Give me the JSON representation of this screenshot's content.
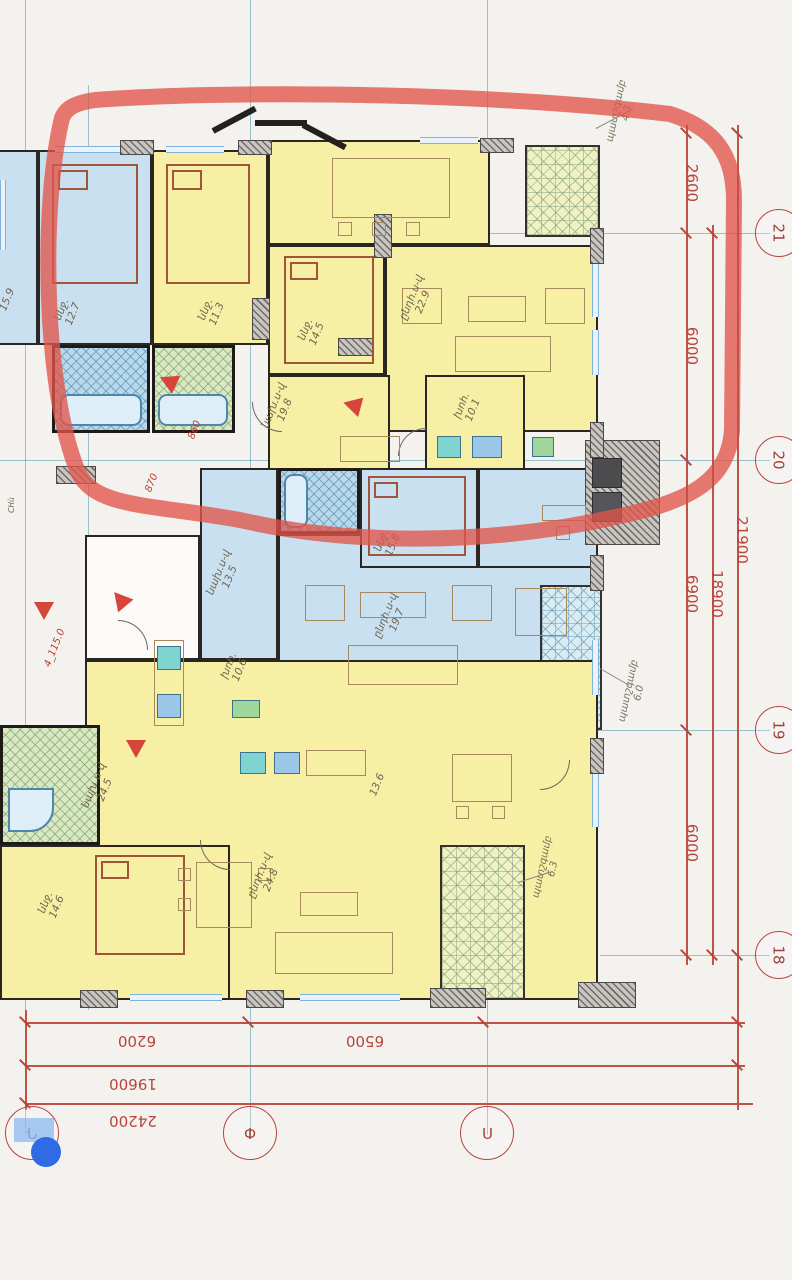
{
  "drawing_type": "apartment-building-floor-plan",
  "language": "Armenian",
  "rooms": {
    "cutleft": {
      "name": "",
      "area": "15.9"
    },
    "bed_blue": {
      "name": "ննջ.",
      "area": "12.7"
    },
    "bed_y1": {
      "name": "ննջ.",
      "area": "11.3"
    },
    "bed_y2": {
      "name": "ննջ.",
      "area": "14.5"
    },
    "living_top": {
      "name": "ընդհ.ս-վ",
      "area": "22.9"
    },
    "hall_top": {
      "name": "նախ.ս-վ",
      "area": "19.8"
    },
    "kitchen_top": {
      "name": "խոհ.",
      "area": "10.1"
    },
    "balc_top": {
      "name": "պատշգամբ",
      "area": "4.3"
    },
    "hall_mid": {
      "name": "նախ.ս-վ",
      "area": "13.5"
    },
    "kitchen_mid": {
      "name": "խոհ.",
      "area": "10.6"
    },
    "bed_mid": {
      "name": "ննջ.",
      "area": "15.8"
    },
    "living_mid": {
      "name": "ընդհ.ս-վ",
      "area": "19.7"
    },
    "balc_mid": {
      "name": "պատշգամբ",
      "area": "6.0"
    },
    "hall_bot": {
      "name": "նախ.ս-վ",
      "area": "24.5"
    },
    "bed_bot": {
      "name": "ննջ.",
      "area": "14.6"
    },
    "living_bot": {
      "name": "ընդհ.ս-վ",
      "area": "24.8"
    },
    "kitchen_bot": {
      "name": "",
      "area": "13.6"
    },
    "balc_bot": {
      "name": "պատշգամբ",
      "area": "6.3"
    },
    "shaft": {
      "name": "CHù",
      "area": ""
    }
  },
  "markers": {
    "elev_860": "860",
    "elev_870": "870",
    "elev_115": "4_115.0"
  },
  "dims": {
    "right": [
      "2600",
      "6000",
      "6900",
      "6000",
      "18900",
      "21900"
    ],
    "bottom": [
      "6200",
      "6500",
      "19600",
      "24200"
    ]
  },
  "axes": {
    "right": [
      "21",
      "20",
      "19",
      "18"
    ],
    "bottom": [
      "Դ",
      "Փ",
      "Ո"
    ]
  },
  "colors": {
    "highlight_circle_red": "#e0544a",
    "dimension_red": "#b8453b",
    "selection_blue": "#2e6be5",
    "room_yellow": "#f6efa4",
    "room_blue": "#c9e0f1"
  }
}
